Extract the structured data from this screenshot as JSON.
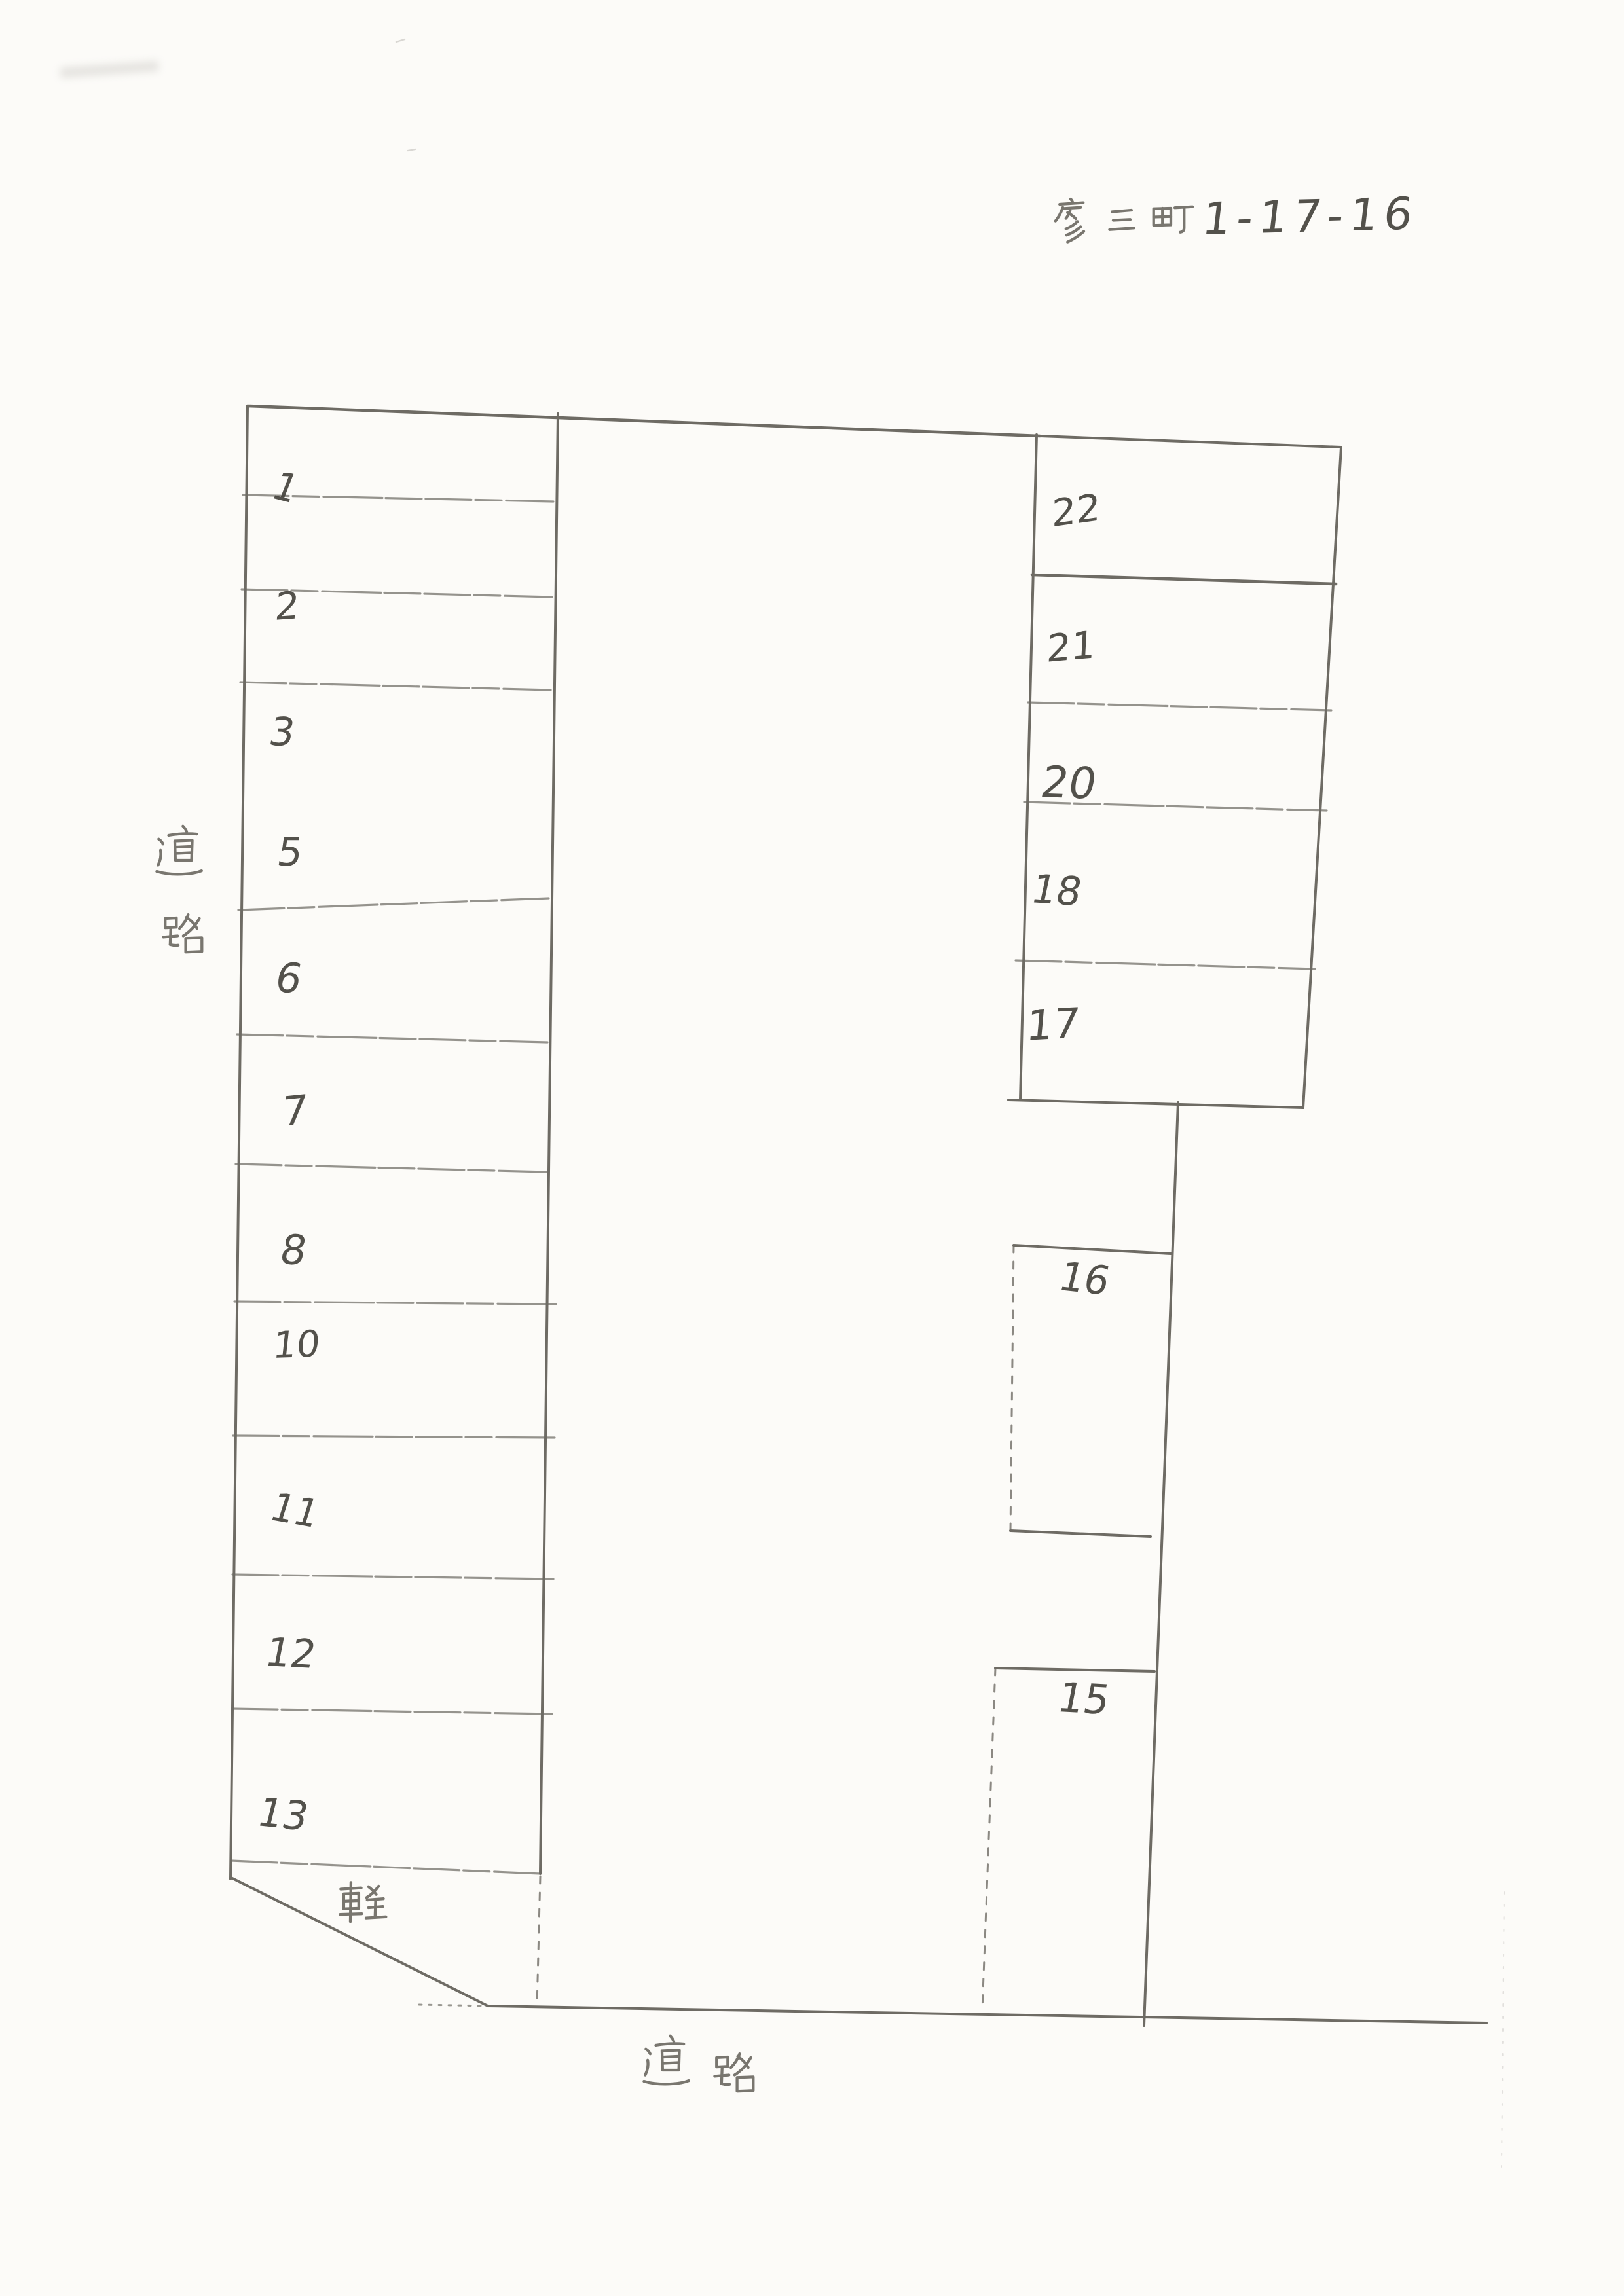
{
  "document": {
    "kind": "hand-drawn parking lot layout sketch (scanned)",
    "title": "彦三町 1-17-16",
    "title_kanji": "彦三町",
    "title_number": "1-17-16"
  },
  "labels": {
    "road_left": "道路",
    "road_left_char_top": "道",
    "road_left_char_bottom": "路",
    "road_bottom": "道路",
    "kei_stall": "軽"
  },
  "stalls": {
    "left_column": [
      "1",
      "2",
      "3",
      "5",
      "6",
      "7",
      "8",
      "10",
      "11",
      "12",
      "13"
    ],
    "right_column": [
      "22",
      "21",
      "20",
      "18",
      "17"
    ],
    "middle": [
      "16",
      "15"
    ]
  },
  "colors": {
    "paper": "#fcfbf8",
    "pencil_line": "#6e6b64",
    "pencil_text": "#45433d"
  }
}
